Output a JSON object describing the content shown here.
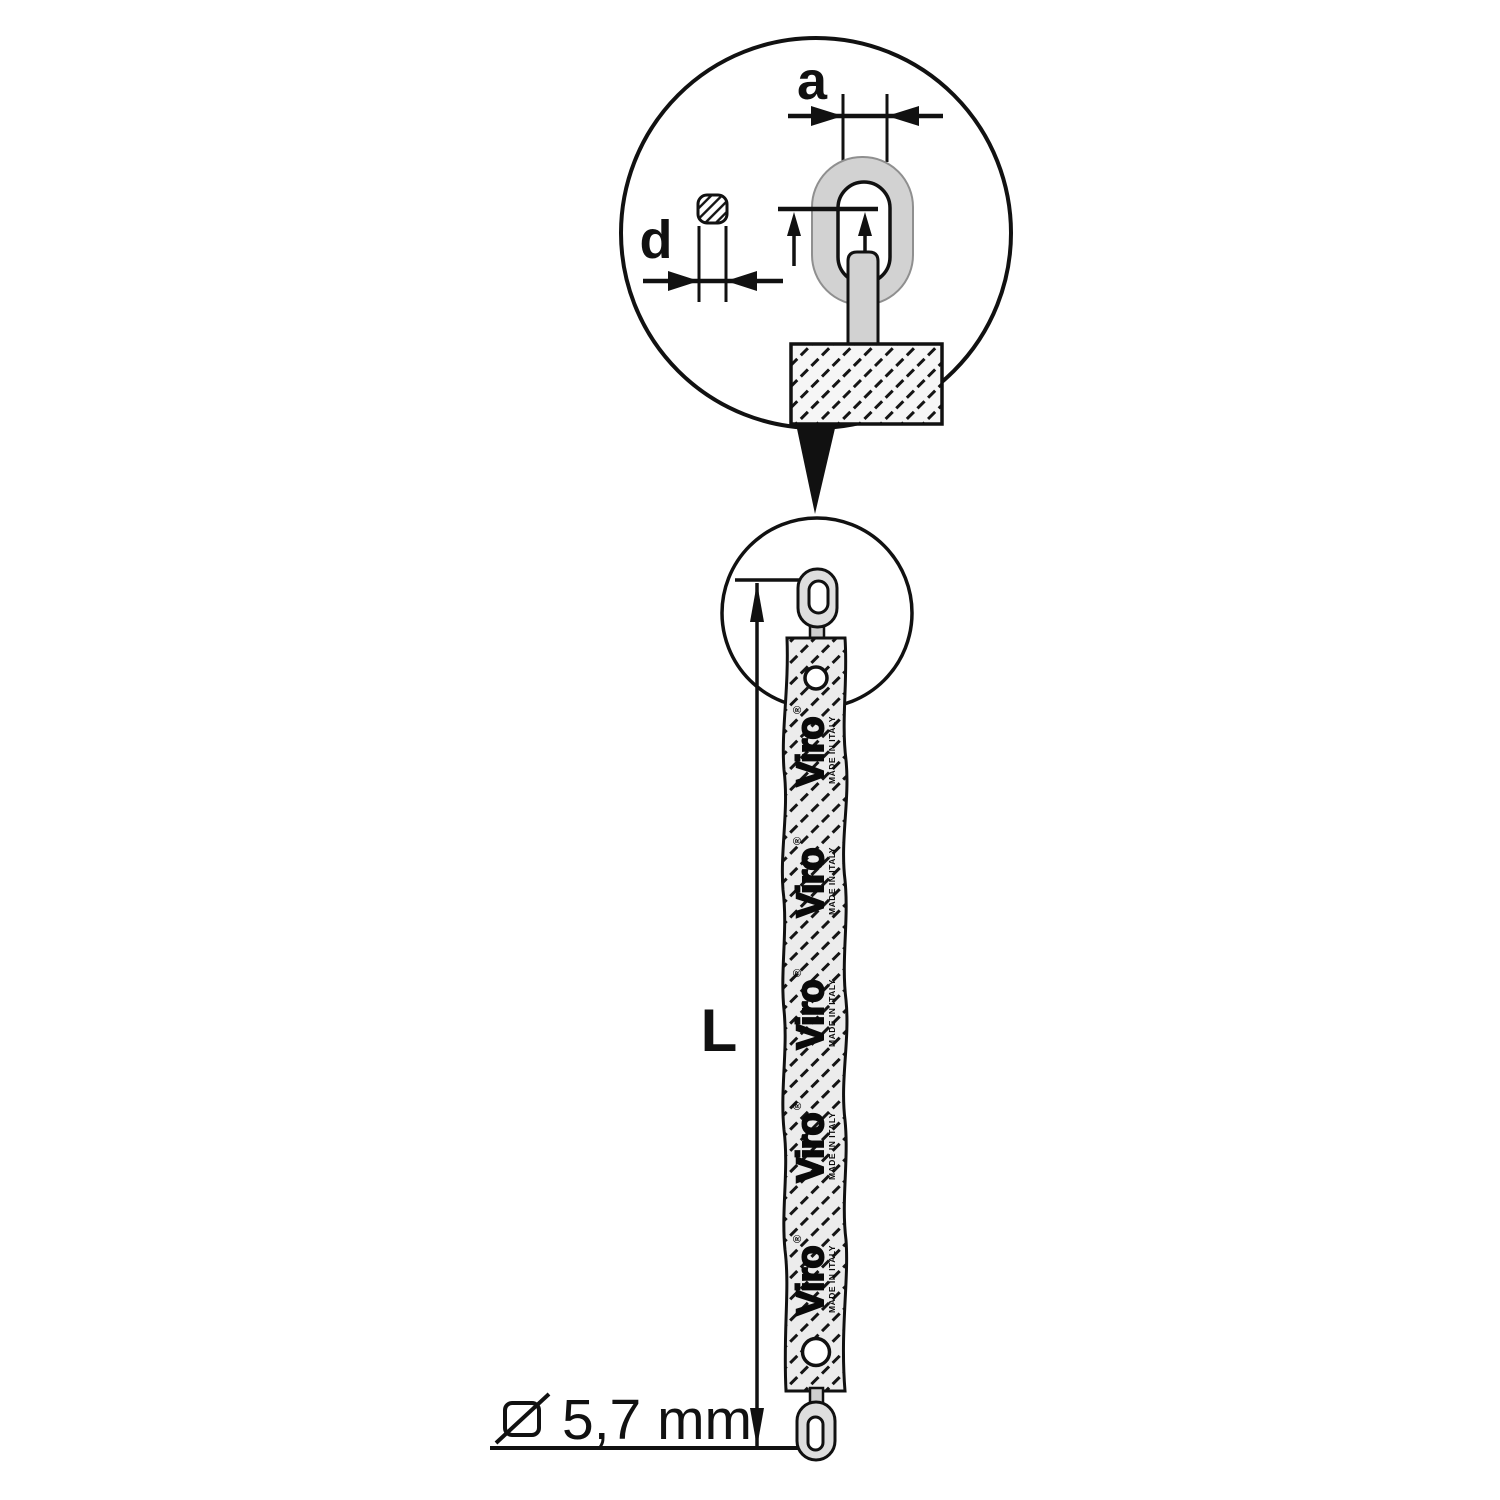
{
  "diagram": {
    "detail_labels": {
      "a": "a",
      "d": "d"
    },
    "length_label": "L",
    "diameter_value": "5,7 mm",
    "brand": {
      "name": "Viro",
      "registered": "®",
      "made_in": "MADE IN ITALY"
    },
    "colors": {
      "line": "#111111",
      "link_fill": "#d2d2d2",
      "end_link_fill": "#dedede",
      "sleeve_fill": "#ececec",
      "block_fill": "#f6f6f6",
      "background": "#ffffff"
    }
  }
}
